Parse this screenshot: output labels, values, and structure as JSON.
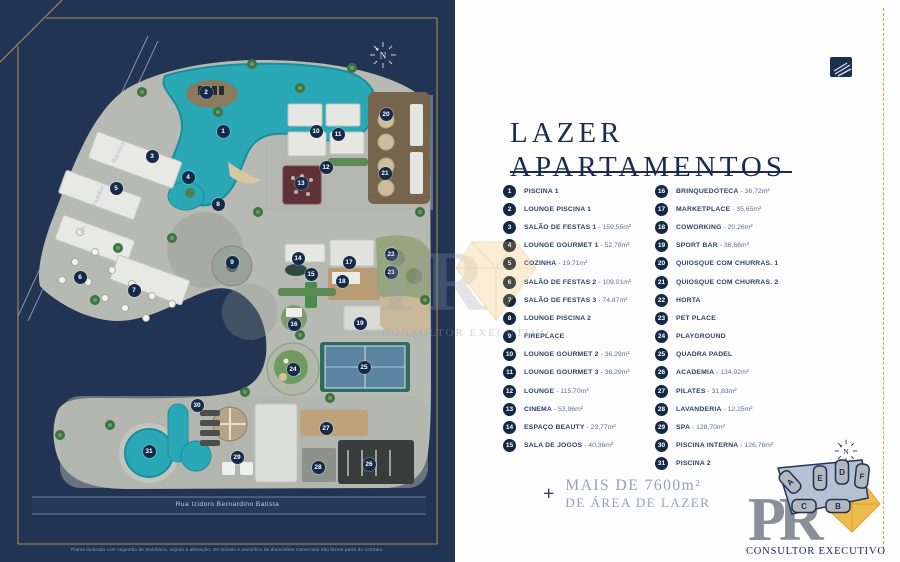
{
  "map": {
    "avenue_label": "Av. Governador Celso Ramos",
    "street_label": "Rua Izidoro Bernardino Batista",
    "disclaimer": "Planta ilustrada com sugestão de mobiliário, sujeito a alteração. Os móveis e utensílios de dimensões comerciais não fazem parte do contrato.",
    "compass_n": "N",
    "markers": [
      {
        "n": "1",
        "x": 223,
        "y": 131
      },
      {
        "n": "2",
        "x": 206,
        "y": 92
      },
      {
        "n": "3",
        "x": 152,
        "y": 156
      },
      {
        "n": "4",
        "x": 188,
        "y": 177
      },
      {
        "n": "5",
        "x": 116,
        "y": 188
      },
      {
        "n": "6",
        "x": 80,
        "y": 277
      },
      {
        "n": "7",
        "x": 134,
        "y": 290
      },
      {
        "n": "8",
        "x": 218,
        "y": 204
      },
      {
        "n": "9",
        "x": 232,
        "y": 262
      },
      {
        "n": "10",
        "x": 316,
        "y": 131
      },
      {
        "n": "11",
        "x": 338,
        "y": 134
      },
      {
        "n": "12",
        "x": 326,
        "y": 167
      },
      {
        "n": "13",
        "x": 301,
        "y": 183
      },
      {
        "n": "14",
        "x": 298,
        "y": 258
      },
      {
        "n": "15",
        "x": 311,
        "y": 274
      },
      {
        "n": "16",
        "x": 294,
        "y": 324
      },
      {
        "n": "17",
        "x": 349,
        "y": 262
      },
      {
        "n": "18",
        "x": 342,
        "y": 281
      },
      {
        "n": "19",
        "x": 360,
        "y": 323
      },
      {
        "n": "20",
        "x": 386,
        "y": 114
      },
      {
        "n": "21",
        "x": 385,
        "y": 173
      },
      {
        "n": "22",
        "x": 391,
        "y": 254
      },
      {
        "n": "23",
        "x": 391,
        "y": 272
      },
      {
        "n": "24",
        "x": 293,
        "y": 369
      },
      {
        "n": "25",
        "x": 364,
        "y": 367
      },
      {
        "n": "26",
        "x": 369,
        "y": 464
      },
      {
        "n": "27",
        "x": 326,
        "y": 428
      },
      {
        "n": "28",
        "x": 318,
        "y": 467
      },
      {
        "n": "29",
        "x": 237,
        "y": 457
      },
      {
        "n": "30",
        "x": 197,
        "y": 405
      },
      {
        "n": "31",
        "x": 149,
        "y": 451
      }
    ]
  },
  "legend": {
    "title_line1": "LAZER",
    "title_line2": "APARTAMENTOS",
    "items_left": [
      {
        "n": "1",
        "label": "PISCINA 1",
        "area": ""
      },
      {
        "n": "2",
        "label": "LOUNGE PISCINA 1",
        "area": ""
      },
      {
        "n": "3",
        "label": "SALÃO DE FESTAS 1",
        "area": "159,55m²"
      },
      {
        "n": "4",
        "label": "LOUNGE GOURMET 1",
        "area": "52,78m²"
      },
      {
        "n": "5",
        "label": "COZINHA",
        "area": "19,71m²"
      },
      {
        "n": "6",
        "label": "SALÃO DE FESTAS 2",
        "area": "109,01m²"
      },
      {
        "n": "7",
        "label": "SALÃO DE FESTAS 3",
        "area": "74,87m²"
      },
      {
        "n": "8",
        "label": "LOUNGE PISCINA 2",
        "area": ""
      },
      {
        "n": "9",
        "label": "FIREPLACE",
        "area": ""
      },
      {
        "n": "10",
        "label": "LOUNGE GOURMET 2",
        "area": "36,29m²"
      },
      {
        "n": "11",
        "label": "LOUNGE GOURMET 3",
        "area": "36,29m²"
      },
      {
        "n": "12",
        "label": "LOUNGE",
        "area": "115,70m²"
      },
      {
        "n": "13",
        "label": "CINEMA",
        "area": "53,96m²"
      },
      {
        "n": "14",
        "label": "ESPAÇO BEAUTY",
        "area": "23,77m²"
      },
      {
        "n": "15",
        "label": "SALA DE JOGOS",
        "area": "40,36m²"
      }
    ],
    "items_right": [
      {
        "n": "16",
        "label": "BRINQUEDOTECA",
        "area": "36,72m²"
      },
      {
        "n": "17",
        "label": "MARKETPLACE",
        "area": "35,65m²"
      },
      {
        "n": "18",
        "label": "COWORKING",
        "area": "20,26m²"
      },
      {
        "n": "19",
        "label": "SPORT BAR",
        "area": "36,66m²"
      },
      {
        "n": "20",
        "label": "QUIOSQUE COM CHURRAS. 1",
        "area": ""
      },
      {
        "n": "21",
        "label": "QUIOSQUE COM CHURRAS. 2",
        "area": ""
      },
      {
        "n": "22",
        "label": "HORTA",
        "area": ""
      },
      {
        "n": "23",
        "label": "PET PLACE",
        "area": ""
      },
      {
        "n": "24",
        "label": "PLAYGROUND",
        "area": ""
      },
      {
        "n": "25",
        "label": "QUADRA PADEL",
        "area": ""
      },
      {
        "n": "26",
        "label": "ACADEMIA",
        "area": "134,92m²"
      },
      {
        "n": "27",
        "label": "PILATES",
        "area": "31,83m²"
      },
      {
        "n": "28",
        "label": "LAVANDERIA",
        "area": "12,25m²"
      },
      {
        "n": "29",
        "label": "SPA",
        "area": "128,70m²"
      },
      {
        "n": "30",
        "label": "PISCINA INTERNA",
        "area": "126,76m²"
      },
      {
        "n": "31",
        "label": "PISCINA 2",
        "area": ""
      }
    ],
    "footer": {
      "plus": "+",
      "line1": "MAIS DE 7600m²",
      "line2": "DE ÁREA DE LAZER"
    }
  },
  "branding": {
    "logo_letters": "PR",
    "name": "CONSULTOR EXECUTIVO",
    "towers": [
      "A",
      "B",
      "C",
      "D",
      "E",
      "F"
    ],
    "compass_n": "N"
  },
  "colors": {
    "navy": "#213453",
    "gold": "#c9a45c",
    "teal": "#2ba8b6",
    "legend_navy": "#142844"
  }
}
